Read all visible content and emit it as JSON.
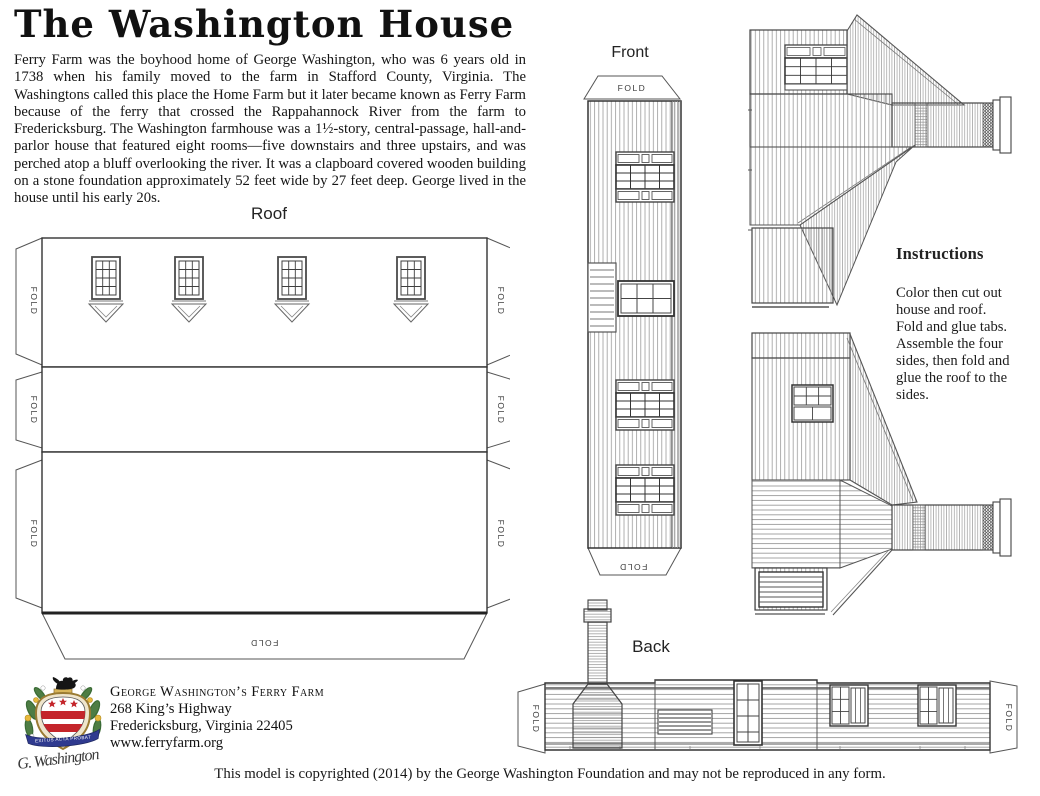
{
  "page": {
    "title": "The Washington House",
    "intro": "Ferry Farm was the boyhood home of George Washington, who was 6 years old in 1738 when his family moved to the farm in Stafford County, Virginia. The Washingtons called this place the Home Farm but it later became known as Ferry Farm because of the ferry that crossed the Rappahannock River from the farm to Fredericksburg. The Washington farmhouse was a 1½-story, central-passage, hall-and-parlor house that featured eight rooms—five downstairs and three upstairs, and was perched atop a bluff overlooking the river. It was a clapboard covered wooden building on a stone foundation approximately 52 feet wide by 27 feet deep. George lived in the house until his early 20s.",
    "copyright": "This model is copyrighted (2014) by the George Washington Foundation and may not be reproduced in any form."
  },
  "labels": {
    "roof": "Roof",
    "front": "Front",
    "back": "Back",
    "fold": "FOLD"
  },
  "instructions": {
    "heading": "Instructions",
    "lines": [
      "Color then cut out",
      "house and roof.",
      "Fold and glue tabs.",
      "Assemble the four",
      "sides, then fold and",
      "glue the roof to the",
      "sides."
    ]
  },
  "footer": {
    "org": "George Washington’s Ferry Farm",
    "address1": "268 King’s Highway",
    "address2": "Fredericksburg, Virginia 22405",
    "website": "www.ferryfarm.org",
    "motto": "EXITUS ACTA PROBAT",
    "signature": "G. Washington"
  },
  "colors": {
    "crest_red": "#c4252b",
    "crest_blue": "#2f3a8f",
    "crest_green": "#3a6b35",
    "crest_gold": "#c9a84c",
    "line_art": "#4a4a4a"
  }
}
